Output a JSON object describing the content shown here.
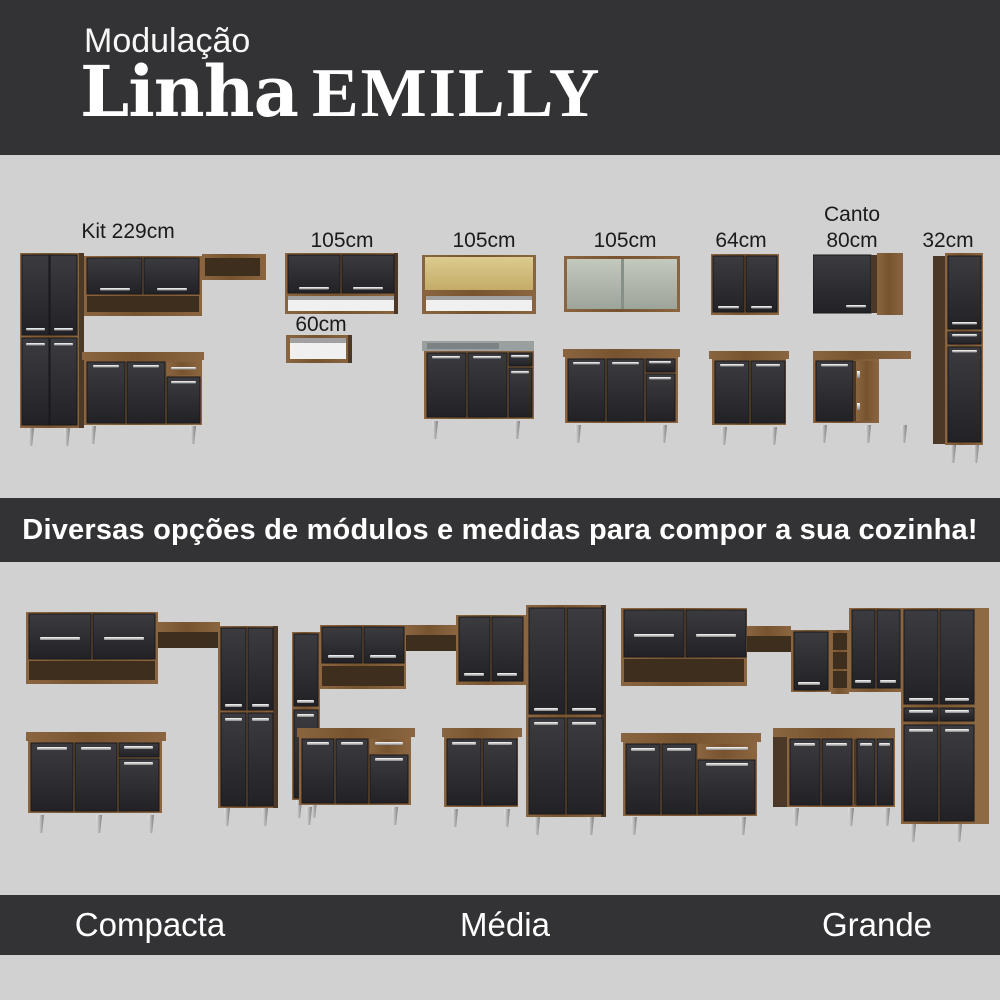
{
  "header": {
    "kicker": "Modulação",
    "title_linha": "Linha",
    "title_emilly": "EMILLY"
  },
  "modules": {
    "kit229": {
      "label": "Kit 229cm"
    },
    "wall105": {
      "label": "105cm"
    },
    "glass105": {
      "label": "105cm"
    },
    "slide105": {
      "label": "105cm"
    },
    "wall64": {
      "label": "64cm"
    },
    "canto80": {
      "line1": "Canto",
      "line2": "80cm"
    },
    "tall32": {
      "label": "32cm"
    },
    "niche60": {
      "label": "60cm"
    }
  },
  "tagline": {
    "text": "Diversas opções de módulos e medidas para compor a sua cozinha!"
  },
  "kitchens": [
    {
      "name": "Compacta"
    },
    {
      "name": "Média"
    },
    {
      "name": "Grande"
    }
  ],
  "colors": {
    "band_dark": "#333234",
    "background": "#d1d1d1",
    "door_black": "#2b2b2e",
    "wood_brown": "#7d5b39",
    "handle_silver": "#c9c9c9",
    "text_light": "#ffffff",
    "text_dark": "#1b1b1b"
  }
}
